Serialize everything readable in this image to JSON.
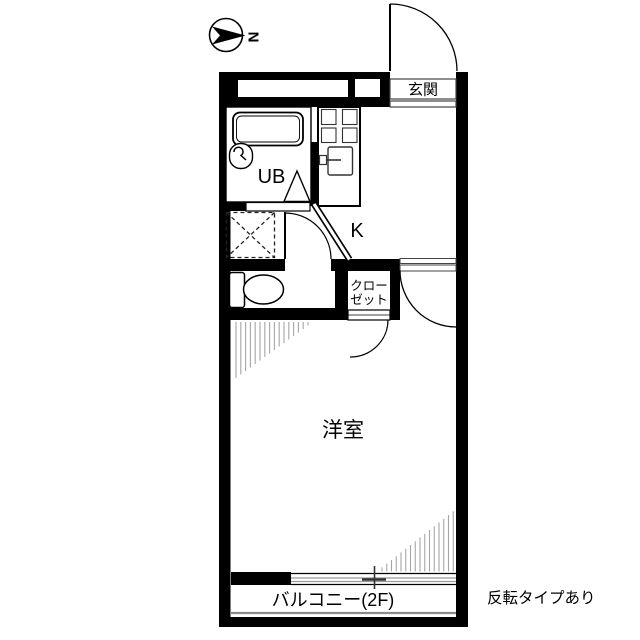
{
  "plan": {
    "compass": {
      "north_label": "N"
    },
    "labels": {
      "entrance": "玄関",
      "unit_bath": "UB",
      "kitchen": "K",
      "closet_line1": "クロー",
      "closet_line2": "ゼット",
      "western_room": "洋室",
      "balcony": "バルコニー(2F)",
      "note": "反転タイプあり"
    },
    "colors": {
      "wall": "#000000",
      "thin_line": "#444444",
      "hatch": "#a6a6a6",
      "rail": "#8a8a8a"
    },
    "hatch_left": {
      "x0": 236,
      "step": 4.8,
      "count": 16,
      "y_top": 322,
      "len_start": 56,
      "len_step": -3.5
    },
    "hatch_right": {
      "x0": 382,
      "step": 4.75,
      "count": 16,
      "y_base": 571.5,
      "len_start": 4,
      "len_step": 3.75
    }
  }
}
